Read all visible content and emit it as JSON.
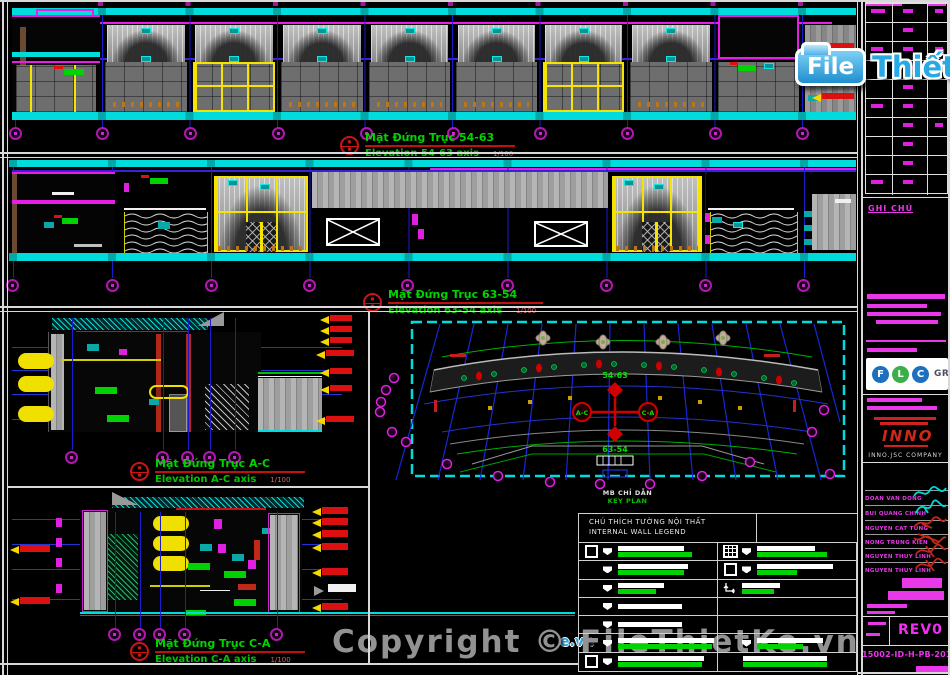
{
  "brand": {
    "logo": {
      "file": "File",
      "thiet": "Thiết",
      "ke": "Kế",
      "vn": ".vn"
    },
    "logo_fragment": "e.vn",
    "copyright": "Copyright © FileThietKe.vn"
  },
  "elevations": [
    {
      "title_vi": "Mặt Đứng Trục 54-63",
      "title_en": "Elevation 54-63 axis",
      "scale": "1/100"
    },
    {
      "title_vi": "Mặt Đứng Trục 63-54",
      "title_en": "Elevation 63-54 axis",
      "scale": "1/100"
    },
    {
      "title_vi": "Mặt Đứng Trục A-C",
      "title_en": "Elevation A-C axis",
      "scale": "1/100"
    },
    {
      "title_vi": "Mặt Đứng Trục C-A",
      "title_en": "Elevation C-A axis",
      "scale": "1/100"
    }
  ],
  "key_plan": {
    "title_vi": "MB CHỈ DẪN",
    "title_en": "KEY PLAN",
    "markers": {
      "top": "54-63",
      "bottom": "63-54",
      "left": "A-C",
      "right": "C-A"
    }
  },
  "legend": {
    "title_vi": "CHÚ THÍCH TƯỜNG NỘI THẤT",
    "title_en": "INTERNAL WALL LEGEND",
    "icons": [
      "wall-square",
      "brick-hatch",
      "corner-arrow"
    ]
  },
  "title_block": {
    "notes_label": "GHI CHÚ",
    "flc": {
      "l1": "F",
      "l2": "L",
      "l3": "C",
      "group": "GROUP"
    },
    "inno": {
      "name": "INNO",
      "company": "INNO.JSC COMPANY"
    },
    "signers": [
      {
        "name": "DOAN VAN DONG",
        "ink": "cyan"
      },
      {
        "name": "BUI QUANG CHINH",
        "ink": "cyan"
      },
      {
        "name": "NGUYEN CAT TUNG",
        "ink": "red"
      },
      {
        "name": "NONG TRUNG KIEN",
        "ink": "red"
      },
      {
        "name": "NGUYEN THUY LINH",
        "ink": "red"
      },
      {
        "name": "NGUYEN THUY LINH",
        "ink": "red"
      }
    ],
    "revision": "REV0",
    "drawing_number": "15002-ID-H-PB-201.01"
  },
  "colors": {
    "background": "#000000",
    "cyan": "#00dcdc",
    "magenta": "#e820e8",
    "yellow": "#f5e400",
    "green": "#00d400",
    "blue_grid": "#1b1bd0",
    "red": "#d42020",
    "gray_panel": "#9a9a9a",
    "white": "#ffffff",
    "logo_blue": "#29a9e3"
  }
}
